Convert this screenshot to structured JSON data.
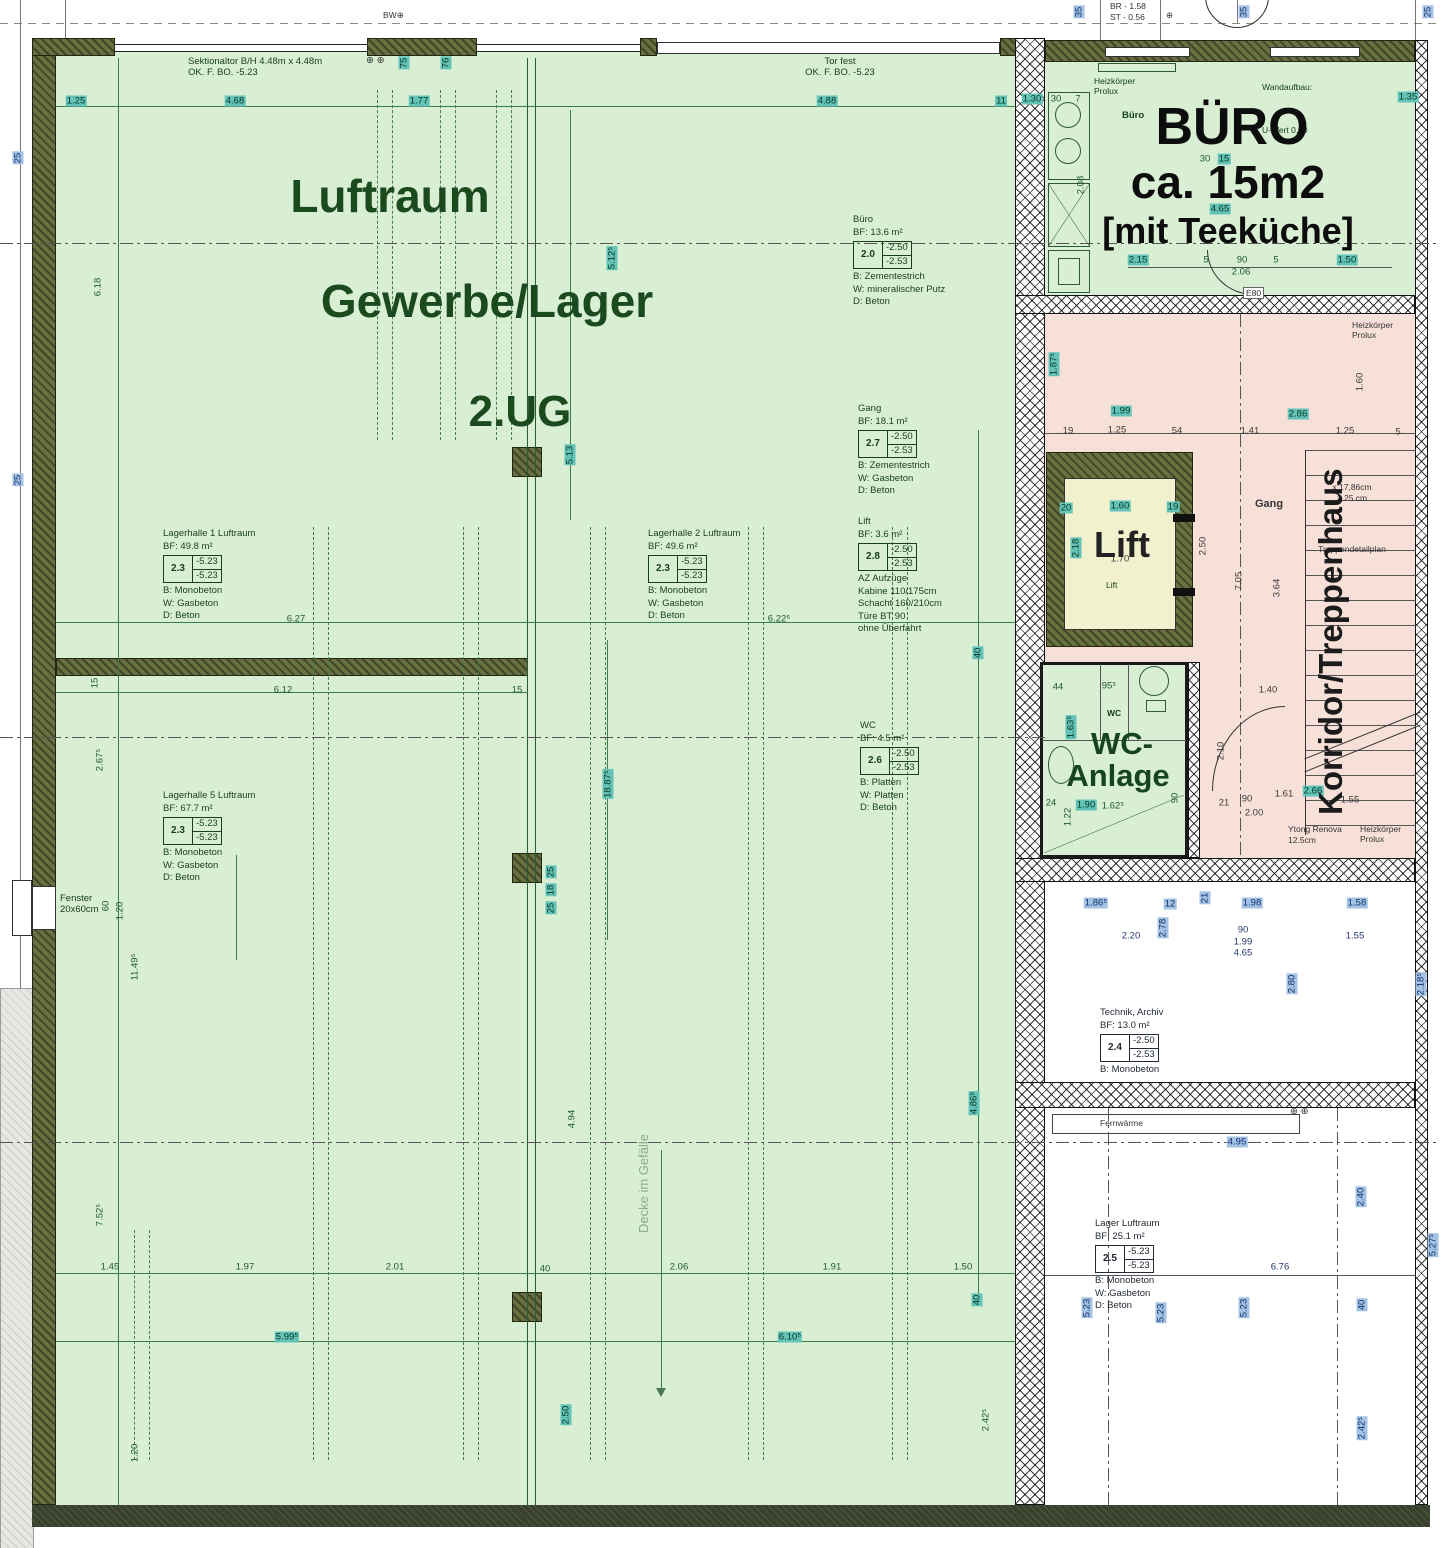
{
  "header": {
    "br": "BR  -  1.58",
    "st": "ST  -  0.56",
    "bw": "BW⊕",
    "plus": "⊕",
    "plus_pair": "⊕ ⊕"
  },
  "big": {
    "luftraum": "Luftraum",
    "gewerbe": "Gewerbe/Lager",
    "ug": "2.UG",
    "buero1": "BÜRO",
    "buero2": "ca. 15m2",
    "buero3": "[mit Teeküche]",
    "lift": "Lift",
    "wc1": "WC-",
    "wc2": "Anlage",
    "korridor": "Korridor/Treppenhaus",
    "decke": "Decke im Gefälle"
  },
  "ann": {
    "sek1": "Sektionaltor B/H 4.48m x 4.48m",
    "sek2": "OK. F. BO. -5.23",
    "tor1": "Tor fest",
    "tor2": "OK. F. BO. -5.23",
    "fenster1": "Fenster",
    "fenster2": "20x60cm",
    "heiz1": "Heizkörper",
    "heiz2": "Prolux",
    "buero_small": "Büro",
    "wand1": "Wandaufbau:",
    "wand2": "U-Wert 0.20",
    "gang": "Gang",
    "lift_small": "Lift",
    "wc_small": "WC",
    "e80": "E80",
    "fern": "Fernwärme",
    "ytong1": "Ytong Renova",
    "ytong2": "12.5cm",
    "st1": "x 17,86cm",
    "st2": "1.25 cm",
    "st3": "Treppendetailplan"
  },
  "rooms": [
    {
      "name": "Büro",
      "bf": "BF: 13.6 m²",
      "level": "2.0",
      "top": "-2.50",
      "bottom": "-2.53",
      "lines": [
        "B: Zementestrich",
        "W: mineralischer Putz",
        "D: Beton"
      ]
    },
    {
      "name": "Gang",
      "bf": "BF: 18.1 m²",
      "level": "2.7",
      "top": "-2.50",
      "bottom": "-2.53",
      "lines": [
        "B: Zementestrich",
        "W: Gasbeton",
        "D: Beton"
      ]
    },
    {
      "name": "Lift",
      "bf": "BF: 3.6 m²",
      "level": "2.8",
      "top": "-2.50",
      "bottom": "-2.53",
      "lines": [
        "AZ Aufzüge",
        "Kabine 110/175cm",
        "Schacht 160/210cm",
        "Türe BT 90",
        "ohne Überfahrt"
      ]
    },
    {
      "name": "WC",
      "bf": "BF: 4.5 m²",
      "level": "2.6",
      "top": "-2.50",
      "bottom": "-2.53",
      "lines": [
        "B: Platten",
        "W: Platten",
        "D: Beton"
      ]
    },
    {
      "name": "Lagerhalle 1 Luftraum",
      "bf": "BF: 49.8 m²",
      "level": "2.3",
      "top": "-5.23",
      "bottom": "-5.23",
      "lines": [
        "B: Monobeton",
        "W: Gasbeton",
        "D: Beton"
      ]
    },
    {
      "name": "Lagerhalle 2 Luftraum",
      "bf": "BF: 49.6 m²",
      "level": "2.3",
      "top": "-5.23",
      "bottom": "-5.23",
      "lines": [
        "B: Monobeton",
        "W: Gasbeton",
        "D: Beton"
      ]
    },
    {
      "name": "Lagerhalle 5 Luftraum",
      "bf": "BF: 67.7 m²",
      "level": "2.3",
      "top": "-5.23",
      "bottom": "-5.23",
      "lines": [
        "B: Monobeton",
        "W: Gasbeton",
        "D: Beton"
      ]
    },
    {
      "name": "Technik, Archiv",
      "bf": "BF: 13.0 m²",
      "level": "2.4",
      "top": "-2.50",
      "bottom": "-2.53",
      "lines": [
        "B: Monobeton"
      ]
    },
    {
      "name": "Lager Luftraum",
      "bf": "BF: 25.1 m²",
      "level": "2.5",
      "top": "-5.23",
      "bottom": "-5.23",
      "lines": [
        "B: Monobeton",
        "W: Gasbeton",
        "D: Beton"
      ]
    }
  ],
  "dims": [
    {
      "t": "1.25",
      "x": 76,
      "y": 101,
      "h": "t"
    },
    {
      "t": "4.68",
      "x": 235,
      "y": 101,
      "h": "t"
    },
    {
      "t": "1.77",
      "x": 419,
      "y": 101,
      "h": "t"
    },
    {
      "t": "4.88",
      "x": 827,
      "y": 101,
      "h": "t"
    },
    {
      "t": "11",
      "x": 1001,
      "y": 101,
      "h": "t"
    },
    {
      "t": "75",
      "x": 404,
      "y": 63,
      "r": 1,
      "h": "t"
    },
    {
      "t": "76",
      "x": 446,
      "y": 63,
      "r": 1,
      "h": "t"
    },
    {
      "t": "25",
      "x": 18,
      "y": 158,
      "r": 1,
      "h": "b"
    },
    {
      "t": "25",
      "x": 18,
      "y": 480,
      "r": 1,
      "h": "b"
    },
    {
      "t": "35",
      "x": 1079,
      "y": 12,
      "r": 1,
      "h": "b"
    },
    {
      "t": "35",
      "x": 1244,
      "y": 12,
      "r": 1,
      "h": "b"
    },
    {
      "t": "25",
      "x": 1428,
      "y": 12,
      "r": 1,
      "h": "b"
    },
    {
      "t": "6.18",
      "x": 98,
      "y": 287,
      "r": 1
    },
    {
      "t": "5.12⁵",
      "x": 612,
      "y": 258,
      "r": 1,
      "h": "t"
    },
    {
      "t": "6.27",
      "x": 296,
      "y": 619
    },
    {
      "t": "6.22⁵",
      "x": 779,
      "y": 619
    },
    {
      "t": "6.12",
      "x": 283,
      "y": 690
    },
    {
      "t": "15",
      "x": 517,
      "y": 690
    },
    {
      "t": "15",
      "x": 95,
      "y": 683,
      "r": 1
    },
    {
      "t": "2.67⁵",
      "x": 100,
      "y": 760,
      "r": 1
    },
    {
      "t": "5.13",
      "x": 570,
      "y": 455,
      "r": 1,
      "h": "t"
    },
    {
      "t": "18.87⁵",
      "x": 608,
      "y": 784,
      "r": 1,
      "h": "t"
    },
    {
      "t": "40",
      "x": 978,
      "y": 653,
      "r": 1,
      "h": "t"
    },
    {
      "t": "60",
      "x": 106,
      "y": 906,
      "r": 1
    },
    {
      "t": "1.20",
      "x": 120,
      "y": 911,
      "r": 1
    },
    {
      "t": "11.49⁵",
      "x": 135,
      "y": 967,
      "r": 1
    },
    {
      "t": "25",
      "x": 551,
      "y": 872,
      "r": 1,
      "h": "t"
    },
    {
      "t": "18",
      "x": 551,
      "y": 890,
      "r": 1,
      "h": "t"
    },
    {
      "t": "25",
      "x": 551,
      "y": 908,
      "r": 1,
      "h": "t"
    },
    {
      "t": "7.52⁵",
      "x": 100,
      "y": 1215,
      "r": 1
    },
    {
      "t": "4.94",
      "x": 572,
      "y": 1119,
      "r": 1
    },
    {
      "t": "4.86⁵",
      "x": 974,
      "y": 1103,
      "r": 1,
      "h": "t"
    },
    {
      "t": "40",
      "x": 977,
      "y": 1300,
      "r": 1,
      "h": "t"
    },
    {
      "t": "2.50",
      "x": 566,
      "y": 1415,
      "r": 1,
      "h": "t"
    },
    {
      "t": "2.42⁵",
      "x": 986,
      "y": 1420,
      "r": 1
    },
    {
      "t": "1.20",
      "x": 135,
      "y": 1453,
      "r": 1
    },
    {
      "t": "1.45",
      "x": 110,
      "y": 1267
    },
    {
      "t": "1.97",
      "x": 245,
      "y": 1267
    },
    {
      "t": "2.01",
      "x": 395,
      "y": 1267
    },
    {
      "t": "40",
      "x": 545,
      "y": 1269
    },
    {
      "t": "2.06",
      "x": 679,
      "y": 1267
    },
    {
      "t": "1.91",
      "x": 832,
      "y": 1267
    },
    {
      "t": "1.50",
      "x": 963,
      "y": 1267
    },
    {
      "t": "5.99⁵",
      "x": 287,
      "y": 1337,
      "h": "t"
    },
    {
      "t": "6.10⁵",
      "x": 790,
      "y": 1337,
      "h": "t"
    },
    {
      "t": "1.30",
      "x": 1032,
      "y": 99,
      "h": "t"
    },
    {
      "t": "30",
      "x": 1056,
      "y": 99
    },
    {
      "t": "7",
      "x": 1078,
      "y": 99
    },
    {
      "t": "1.35",
      "x": 1408,
      "y": 97,
      "h": "t"
    },
    {
      "t": "2.08",
      "x": 1081,
      "y": 185,
      "r": 1
    },
    {
      "t": "30",
      "x": 1205,
      "y": 159
    },
    {
      "t": "15",
      "x": 1224,
      "y": 159,
      "h": "t"
    },
    {
      "t": "4.65",
      "x": 1220,
      "y": 209,
      "h": "t"
    },
    {
      "t": "2.15",
      "x": 1138,
      "y": 260,
      "h": "t"
    },
    {
      "t": "5",
      "x": 1206,
      "y": 260
    },
    {
      "t": "90",
      "x": 1242,
      "y": 260
    },
    {
      "t": "5",
      "x": 1276,
      "y": 260
    },
    {
      "t": "1.50",
      "x": 1347,
      "y": 260,
      "h": "t"
    },
    {
      "t": "2.06",
      "x": 1241,
      "y": 272
    },
    {
      "t": "1.87⁵",
      "x": 1054,
      "y": 364,
      "r": 1,
      "h": "t"
    },
    {
      "t": "1.99",
      "x": 1121,
      "y": 411,
      "h": "t"
    },
    {
      "t": "2.86",
      "x": 1298,
      "y": 414,
      "h": "t"
    },
    {
      "t": "1.60",
      "x": 1360,
      "y": 382,
      "r": 1,
      "c": "d"
    },
    {
      "t": "19",
      "x": 1068,
      "y": 431,
      "c": "d"
    },
    {
      "t": "1.25",
      "x": 1117,
      "y": 430,
      "c": "d"
    },
    {
      "t": "54",
      "x": 1177,
      "y": 431,
      "c": "d"
    },
    {
      "t": "1.41",
      "x": 1250,
      "y": 431,
      "c": "d"
    },
    {
      "t": "1.25",
      "x": 1345,
      "y": 431,
      "c": "d"
    },
    {
      "t": "5",
      "x": 1398,
      "y": 432,
      "c": "d"
    },
    {
      "t": "20",
      "x": 1066,
      "y": 508,
      "h": "t"
    },
    {
      "t": "1.60",
      "x": 1120,
      "y": 506,
      "h": "t"
    },
    {
      "t": "19",
      "x": 1173,
      "y": 507,
      "h": "t"
    },
    {
      "t": "2.18",
      "x": 1076,
      "y": 548,
      "r": 1,
      "h": "t"
    },
    {
      "t": "1.70",
      "x": 1120,
      "y": 559,
      "c": "d"
    },
    {
      "t": "2.50",
      "x": 1203,
      "y": 546,
      "r": 1,
      "c": "d"
    },
    {
      "t": "7.05",
      "x": 1239,
      "y": 581,
      "r": 1,
      "c": "d"
    },
    {
      "t": "3.64",
      "x": 1277,
      "y": 588,
      "r": 1,
      "c": "d"
    },
    {
      "t": "1.40",
      "x": 1268,
      "y": 690,
      "c": "d"
    },
    {
      "t": "2.10",
      "x": 1221,
      "y": 751,
      "r": 1,
      "c": "d"
    },
    {
      "t": "90",
      "x": 1247,
      "y": 799,
      "c": "d"
    },
    {
      "t": "1.61",
      "x": 1284,
      "y": 794,
      "c": "d"
    },
    {
      "t": "2.66",
      "x": 1313,
      "y": 791,
      "h": "t"
    },
    {
      "t": "1.55",
      "x": 1350,
      "y": 800,
      "c": "d"
    },
    {
      "t": "2.00",
      "x": 1254,
      "y": 813,
      "c": "d"
    },
    {
      "t": "21",
      "x": 1224,
      "y": 803,
      "c": "d"
    },
    {
      "t": "44",
      "x": 1058,
      "y": 687
    },
    {
      "t": "95⁵",
      "x": 1109,
      "y": 686
    },
    {
      "t": "1.63⁵",
      "x": 1071,
      "y": 727,
      "r": 1,
      "h": "t"
    },
    {
      "t": "90",
      "x": 1175,
      "y": 798,
      "r": 1
    },
    {
      "t": "24",
      "x": 1051,
      "y": 803
    },
    {
      "t": "1.22",
      "x": 1068,
      "y": 817,
      "r": 1
    },
    {
      "t": "1.90",
      "x": 1086,
      "y": 805,
      "h": "t"
    },
    {
      "t": "1.62⁵",
      "x": 1113,
      "y": 806
    },
    {
      "t": "1.86⁵",
      "x": 1096,
      "y": 903,
      "h": "b"
    },
    {
      "t": "12",
      "x": 1170,
      "y": 904,
      "h": "b"
    },
    {
      "t": "21",
      "x": 1205,
      "y": 898,
      "r": 1,
      "h": "b"
    },
    {
      "t": "1.98",
      "x": 1252,
      "y": 903,
      "h": "b"
    },
    {
      "t": "1.58",
      "x": 1357,
      "y": 903,
      "h": "b"
    },
    {
      "t": "2.20",
      "x": 1131,
      "y": 936,
      "c": "b"
    },
    {
      "t": "90",
      "x": 1243,
      "y": 930,
      "c": "b"
    },
    {
      "t": "1.99",
      "x": 1243,
      "y": 942,
      "c": "b"
    },
    {
      "t": "1.55",
      "x": 1355,
      "y": 936,
      "c": "b"
    },
    {
      "t": "4.65",
      "x": 1243,
      "y": 953,
      "c": "b"
    },
    {
      "t": "2.78",
      "x": 1163,
      "y": 928,
      "r": 1,
      "h": "b"
    },
    {
      "t": "2.80",
      "x": 1292,
      "y": 984,
      "r": 1,
      "h": "b"
    },
    {
      "t": "2.18⁵",
      "x": 1421,
      "y": 984,
      "r": 1,
      "h": "b"
    },
    {
      "t": "4.95",
      "x": 1237,
      "y": 1142,
      "h": "b"
    },
    {
      "t": "2.40",
      "x": 1361,
      "y": 1197,
      "r": 1,
      "h": "b"
    },
    {
      "t": "6.76",
      "x": 1280,
      "y": 1267,
      "c": "b"
    },
    {
      "t": "40",
      "x": 1362,
      "y": 1305,
      "r": 1,
      "h": "b"
    },
    {
      "t": "5.23",
      "x": 1087,
      "y": 1308,
      "r": 1,
      "h": "b"
    },
    {
      "t": "5.23",
      "x": 1161,
      "y": 1313,
      "r": 1,
      "h": "b"
    },
    {
      "t": "5.23",
      "x": 1244,
      "y": 1308,
      "r": 1,
      "h": "b"
    },
    {
      "t": "2.42⁵",
      "x": 1362,
      "y": 1428,
      "r": 1,
      "h": "b"
    },
    {
      "t": "5.27⁵",
      "x": 1433,
      "y": 1245,
      "r": 1,
      "h": "b"
    }
  ]
}
